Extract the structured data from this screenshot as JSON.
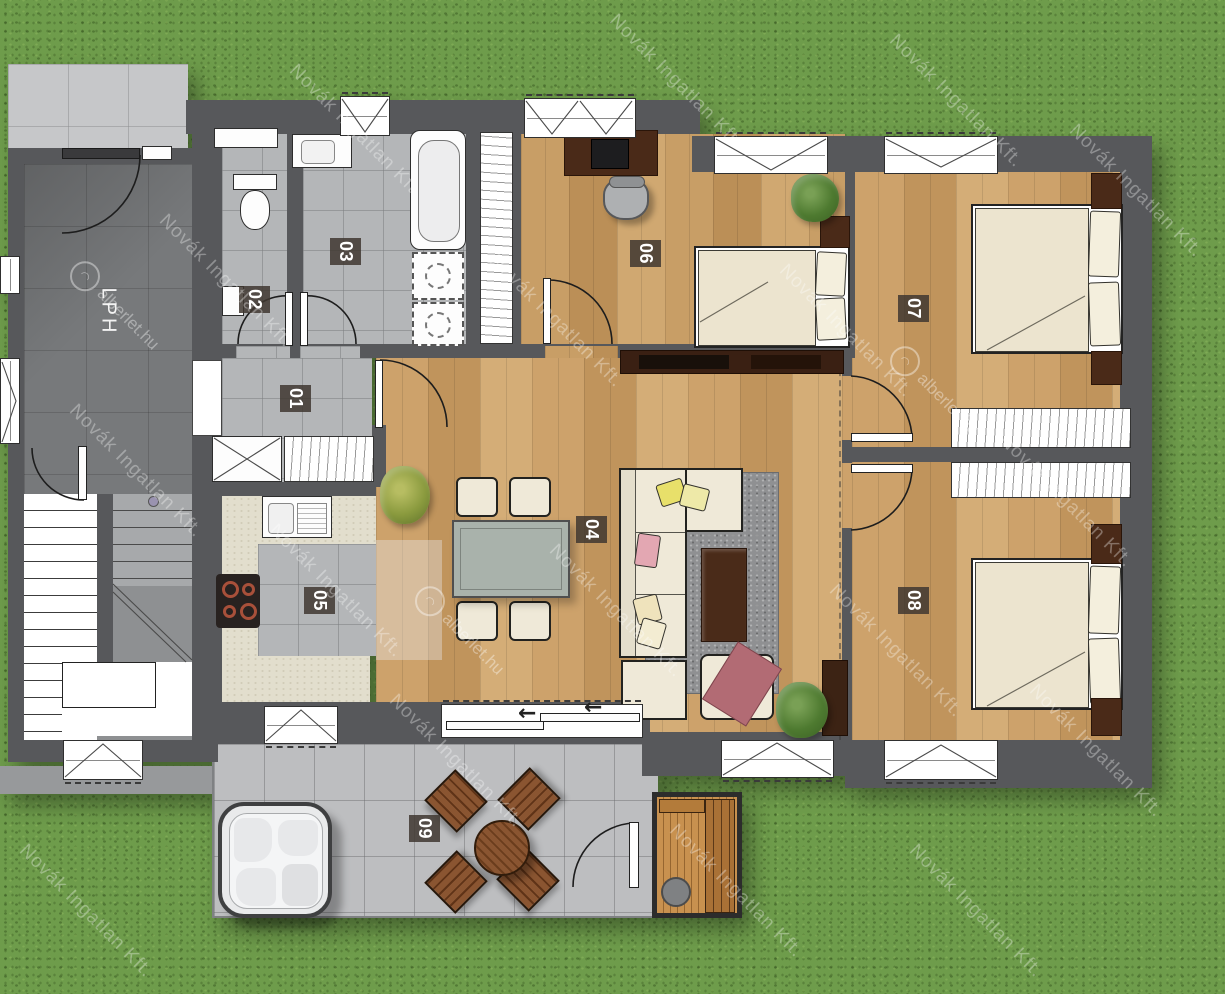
{
  "plan": {
    "hall_label": "LPH",
    "rooms": [
      {
        "num": "01"
      },
      {
        "num": "02"
      },
      {
        "num": "03"
      },
      {
        "num": "04"
      },
      {
        "num": "05"
      },
      {
        "num": "06"
      },
      {
        "num": "07"
      },
      {
        "num": "08"
      },
      {
        "num": "09"
      }
    ],
    "sliding_door_arrow": "←"
  },
  "watermark": {
    "agency": "Novák Ingatlan Kft.",
    "portal": "alberlet.hu"
  },
  "colors": {
    "grass": "#6e9c4b",
    "wall": "#57585b",
    "wood_floor": "#c9a269",
    "tile_floor": "#b4b6b8",
    "hall_floor": "#77797b",
    "terrace": "#bdbec0",
    "counter": "#e2decd",
    "bed_linen": "#ece4cf",
    "label_bg": "#403730",
    "blanket_accent": "#b26b74"
  }
}
